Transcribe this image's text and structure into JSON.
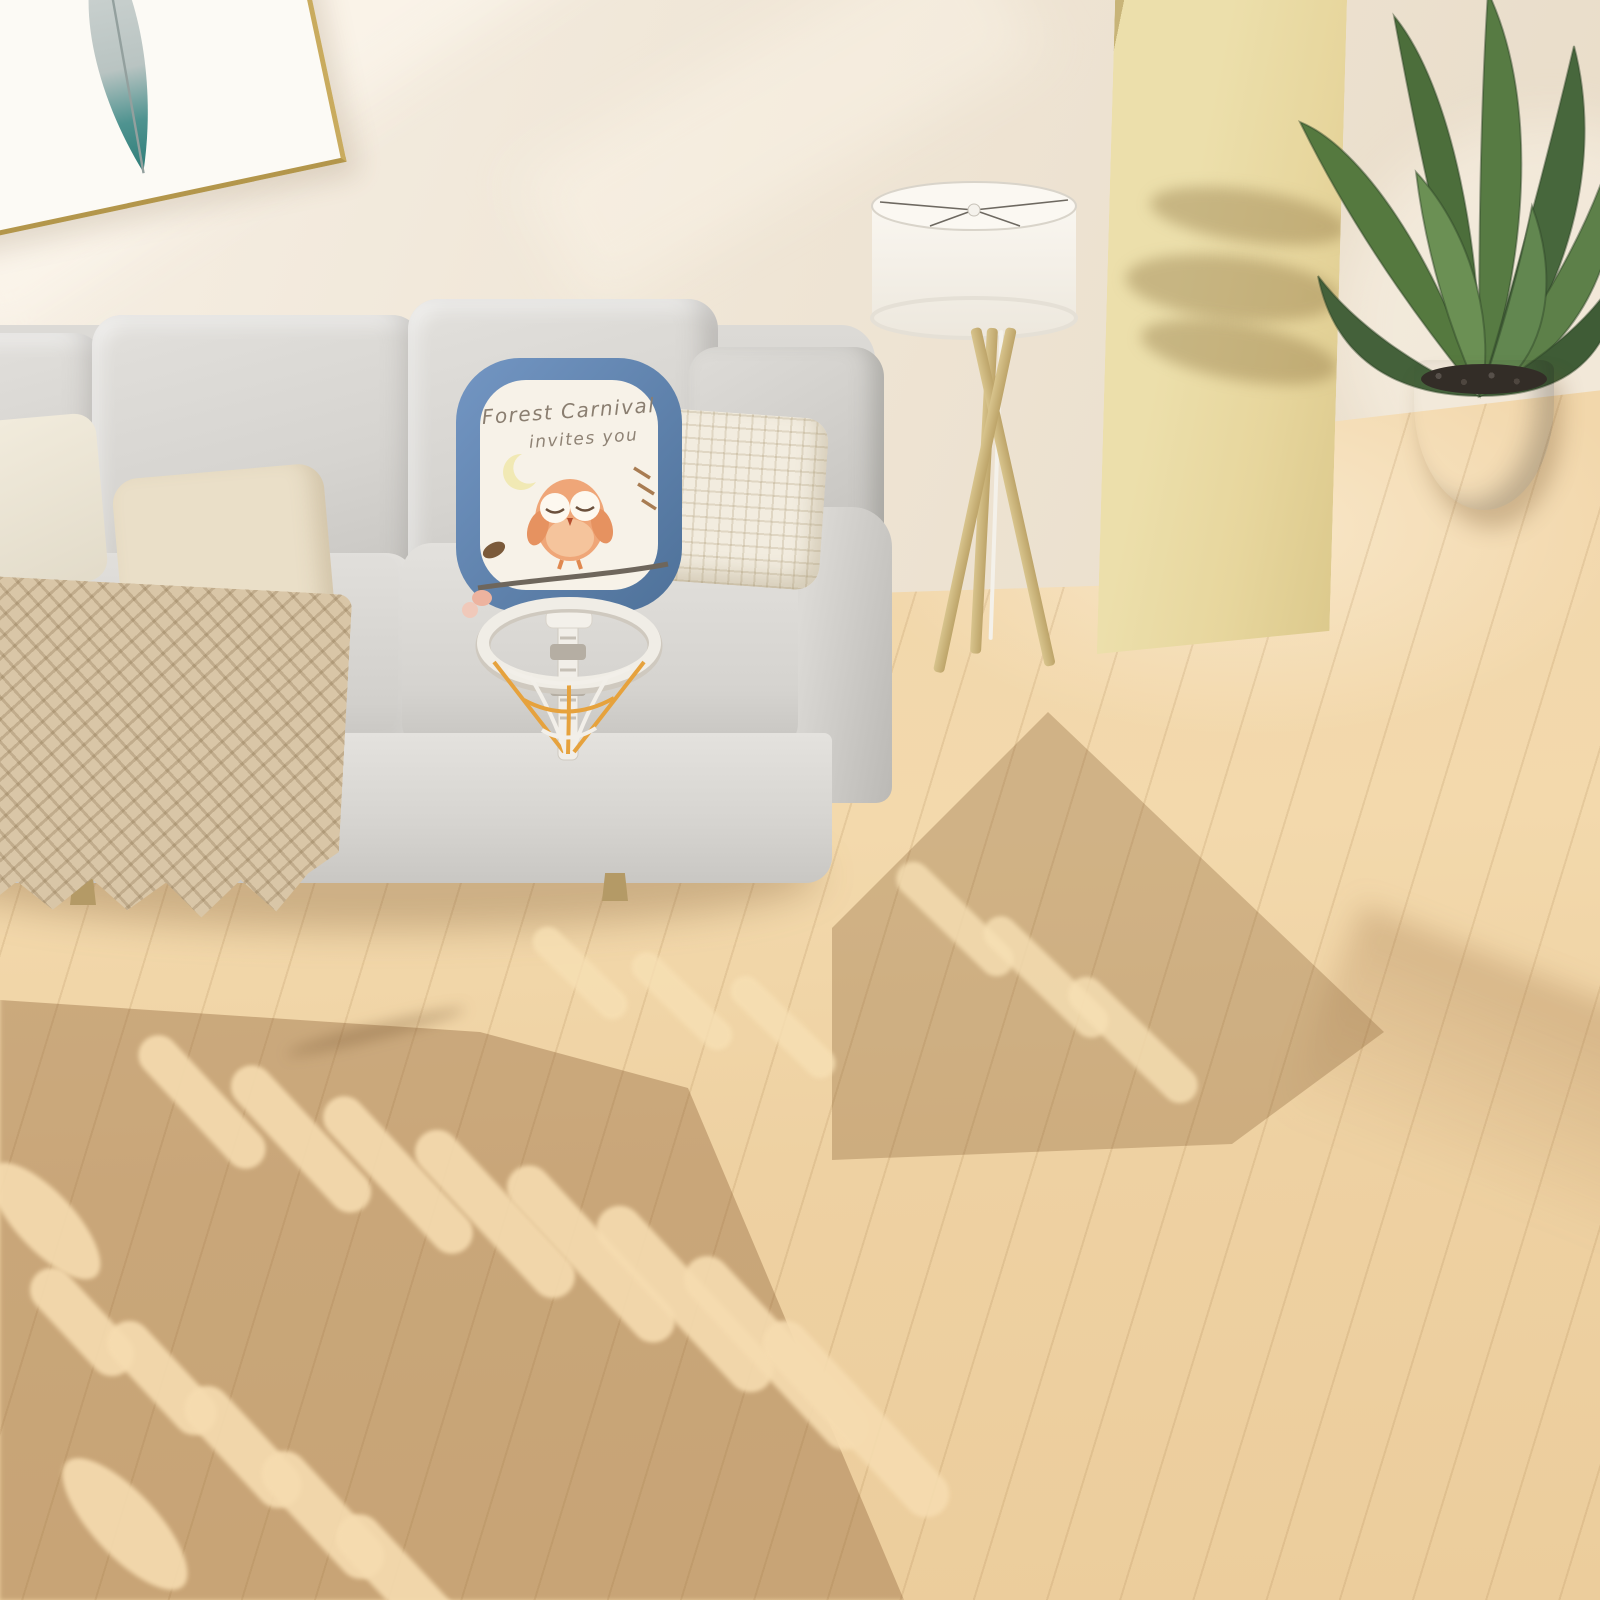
{
  "board": {
    "line1": "Forest Carnival",
    "line2": "invites you",
    "frame_color": "#5d82b4",
    "face_color": "#f6f1e7",
    "owl_color": "#efa678",
    "moon_color": "#f1e9b4"
  },
  "playpen": {
    "star_glyph": "✦",
    "colors": {
      "blue": "#6287b7",
      "cream": "#ece7dc",
      "navy": "#42597b",
      "connector_gray": "#b5aea3"
    },
    "gate": {
      "eyes": 2,
      "beak_color": "#ecd9a0",
      "door_color": "#5d81b1",
      "latch_color": "#f3efe7"
    },
    "sides": {
      "backcorner": {
        "panels": [
          {
            "color": "blue",
            "moon": true,
            "slats": 3,
            "stars": 3,
            "capRight": true
          }
        ]
      },
      "back": {
        "panels": [
          {
            "color": "cream",
            "activity": true,
            "stars": 0
          },
          {
            "color": "blue",
            "moon": true,
            "handle": true,
            "slats": 3,
            "stars": 4
          },
          {
            "color": "cream",
            "handle": true,
            "slats": 3,
            "stars": 2,
            "capRight": true
          }
        ]
      },
      "left": {
        "panels": [
          {
            "color": "navy",
            "slats": 3,
            "stars": 2
          },
          {
            "color": "cream",
            "slats": 3,
            "stars": 1
          },
          {
            "color": "blue",
            "moon": true,
            "slats": 3,
            "stars": 2
          },
          {
            "color": "cream",
            "slats": 3,
            "stars": 1
          }
        ]
      },
      "right": {
        "panels": [
          {
            "color": "navy",
            "moon": true,
            "handle": true,
            "slats": 3,
            "stars": 3
          },
          {
            "color": "cream",
            "slats": 3,
            "stars": 2
          },
          {
            "color": "navy",
            "moon": true,
            "slats": 3,
            "stars": 3
          },
          {
            "color": "cream",
            "moon": true,
            "slats": 3,
            "stars": 2
          },
          {
            "color": "navy",
            "slats": 3,
            "stars": 2,
            "capRight": true
          }
        ]
      },
      "front": {
        "panels": [
          {
            "color": "blue",
            "moon": true,
            "handle": true,
            "slats": 4,
            "stars": 4
          },
          {
            "color": "cream",
            "moon": true,
            "slats": 3,
            "stars": 3
          },
          {
            "color": "cream",
            "gate": true,
            "stars": 0
          },
          {
            "color": "cream",
            "moon": true,
            "slats": 3,
            "stars": 3,
            "capRight": true
          }
        ]
      }
    },
    "activity_toys": [
      "gray-knob",
      "rainbow-ring",
      "pink-moon",
      "pink-star",
      "pink-slider",
      "green-gear",
      "blue-gear",
      "yellow-gear"
    ]
  },
  "room": {
    "wall_color": "#efe5d6",
    "floor_color": "#f2d7ab",
    "objects": [
      "framed feather artwork",
      "gray fabric sofa",
      "knit beige pillow",
      "waffle cream pillow",
      "macrame throw blanket",
      "tripod floor lamp with white drum shade",
      "light wood partition panel",
      "potted banana-leaf plant in gray pot",
      "foldable baby playpen with owl gate",
      "toy basketball hoop with owl board"
    ]
  }
}
